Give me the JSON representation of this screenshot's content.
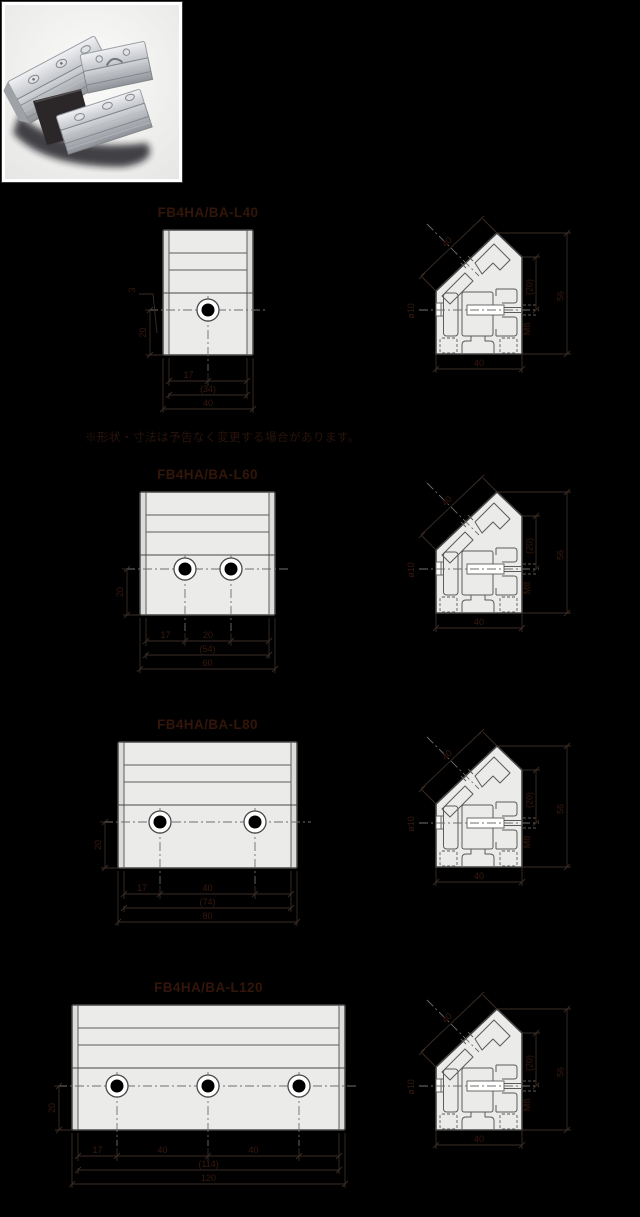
{
  "page": {
    "background": "#000000"
  },
  "photo": {
    "name": "aluminum-free-angle-bracket-photo"
  },
  "note_line": "※形状・寸法は予告なく変更する場合があります。",
  "colors": {
    "background": "#000000",
    "drawing_fill": "#ebebe9",
    "drawing_outline": "#474745",
    "label_text": "#331509",
    "dimension_text": "#381a0e"
  },
  "side_dims": {
    "face": "40",
    "right_inner": "(20)",
    "outer_total": "56",
    "bottom": "40",
    "left": "ø10",
    "screw": "M8"
  },
  "rows": [
    {
      "label": "FB4HA/BA-L40",
      "front": {
        "x": 163,
        "y": 230,
        "w": 90,
        "h": 125,
        "cy": 80,
        "holes": [
          45
        ],
        "segs": [
          "17"
        ],
        "totals": [
          "(34)",
          "40"
        ],
        "dim_left": "20",
        "dim_edge": "3"
      },
      "side": {
        "x": 435,
        "y": 232
      }
    },
    {
      "label": "FB4HA/BA-L60",
      "front": {
        "x": 140,
        "y": 492,
        "w": 135,
        "h": 123,
        "cy": 77,
        "holes": [
          45,
          91
        ],
        "segs": [
          "17",
          "20"
        ],
        "totals": [
          "(54)",
          "60"
        ],
        "dim_left": "20"
      },
      "side": {
        "x": 435,
        "y": 491
      }
    },
    {
      "label": "FB4HA/BA-L80",
      "front": {
        "x": 118,
        "y": 742,
        "w": 179,
        "h": 126,
        "cy": 80,
        "holes": [
          42,
          137
        ],
        "segs": [
          "17",
          "40"
        ],
        "totals": [
          "(74)",
          "80"
        ],
        "dim_left": "20"
      },
      "side": {
        "x": 435,
        "y": 745
      }
    },
    {
      "label": "FB4HA/BA-L120",
      "front": {
        "x": 72,
        "y": 1005,
        "w": 273,
        "h": 125,
        "cy": 81,
        "holes": [
          45,
          136,
          227
        ],
        "segs": [
          "17",
          "40",
          "40"
        ],
        "totals": [
          "(114)",
          "120"
        ],
        "dim_left": "20"
      },
      "side": {
        "x": 435,
        "y": 1008
      }
    }
  ]
}
